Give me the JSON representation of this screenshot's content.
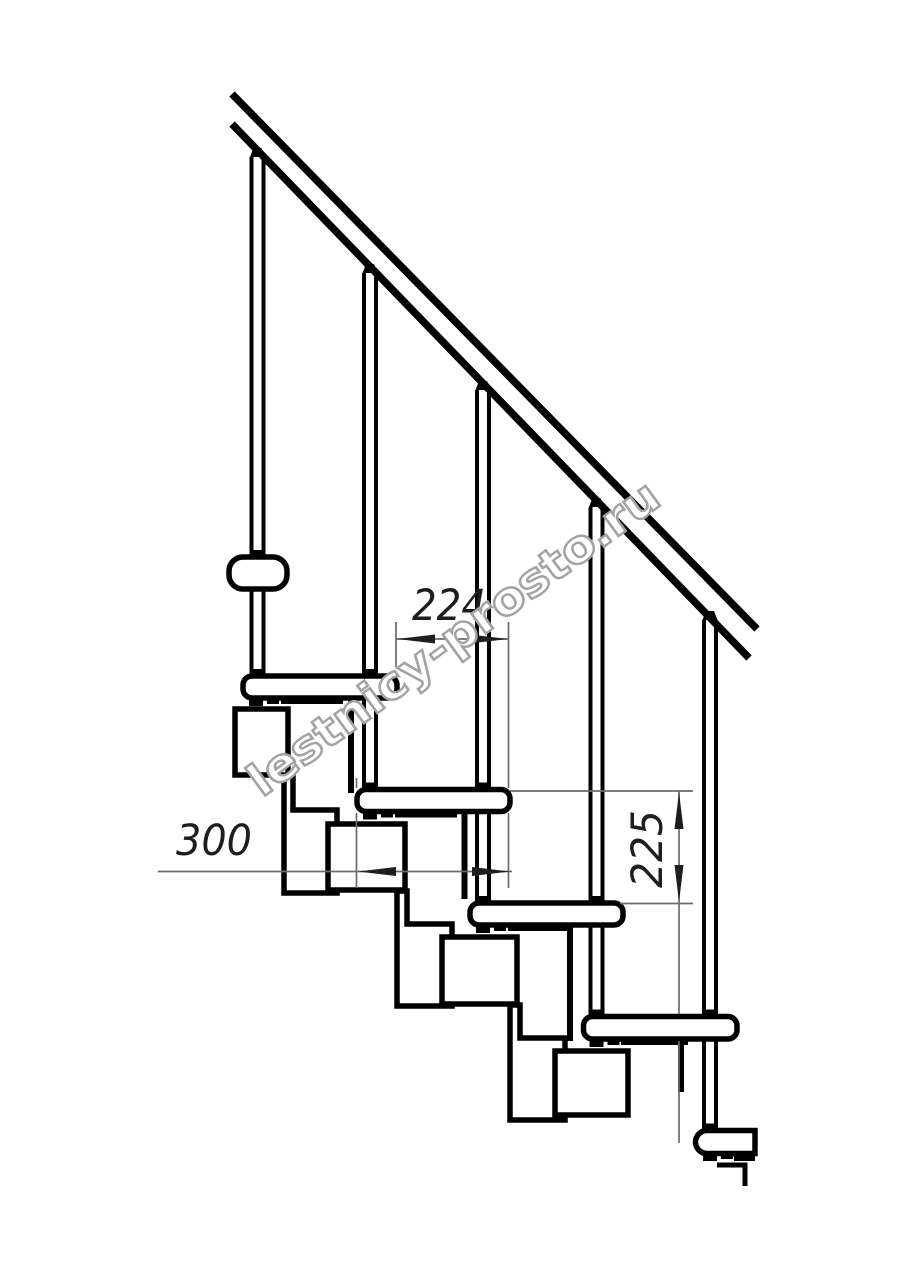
{
  "page": {
    "background": "#ffffff"
  },
  "drawing": {
    "type": "modular-staircase-side-elevation",
    "line_color": "#000000",
    "thin_line_color": "#6b6b6b",
    "dimensions": {
      "going": {
        "label": "224"
      },
      "tread_depth": {
        "label": "300"
      },
      "rise": {
        "label": "225"
      }
    },
    "watermark": {
      "text": "lestnicy-prosto.ru",
      "color": "#a3a3a3"
    }
  }
}
